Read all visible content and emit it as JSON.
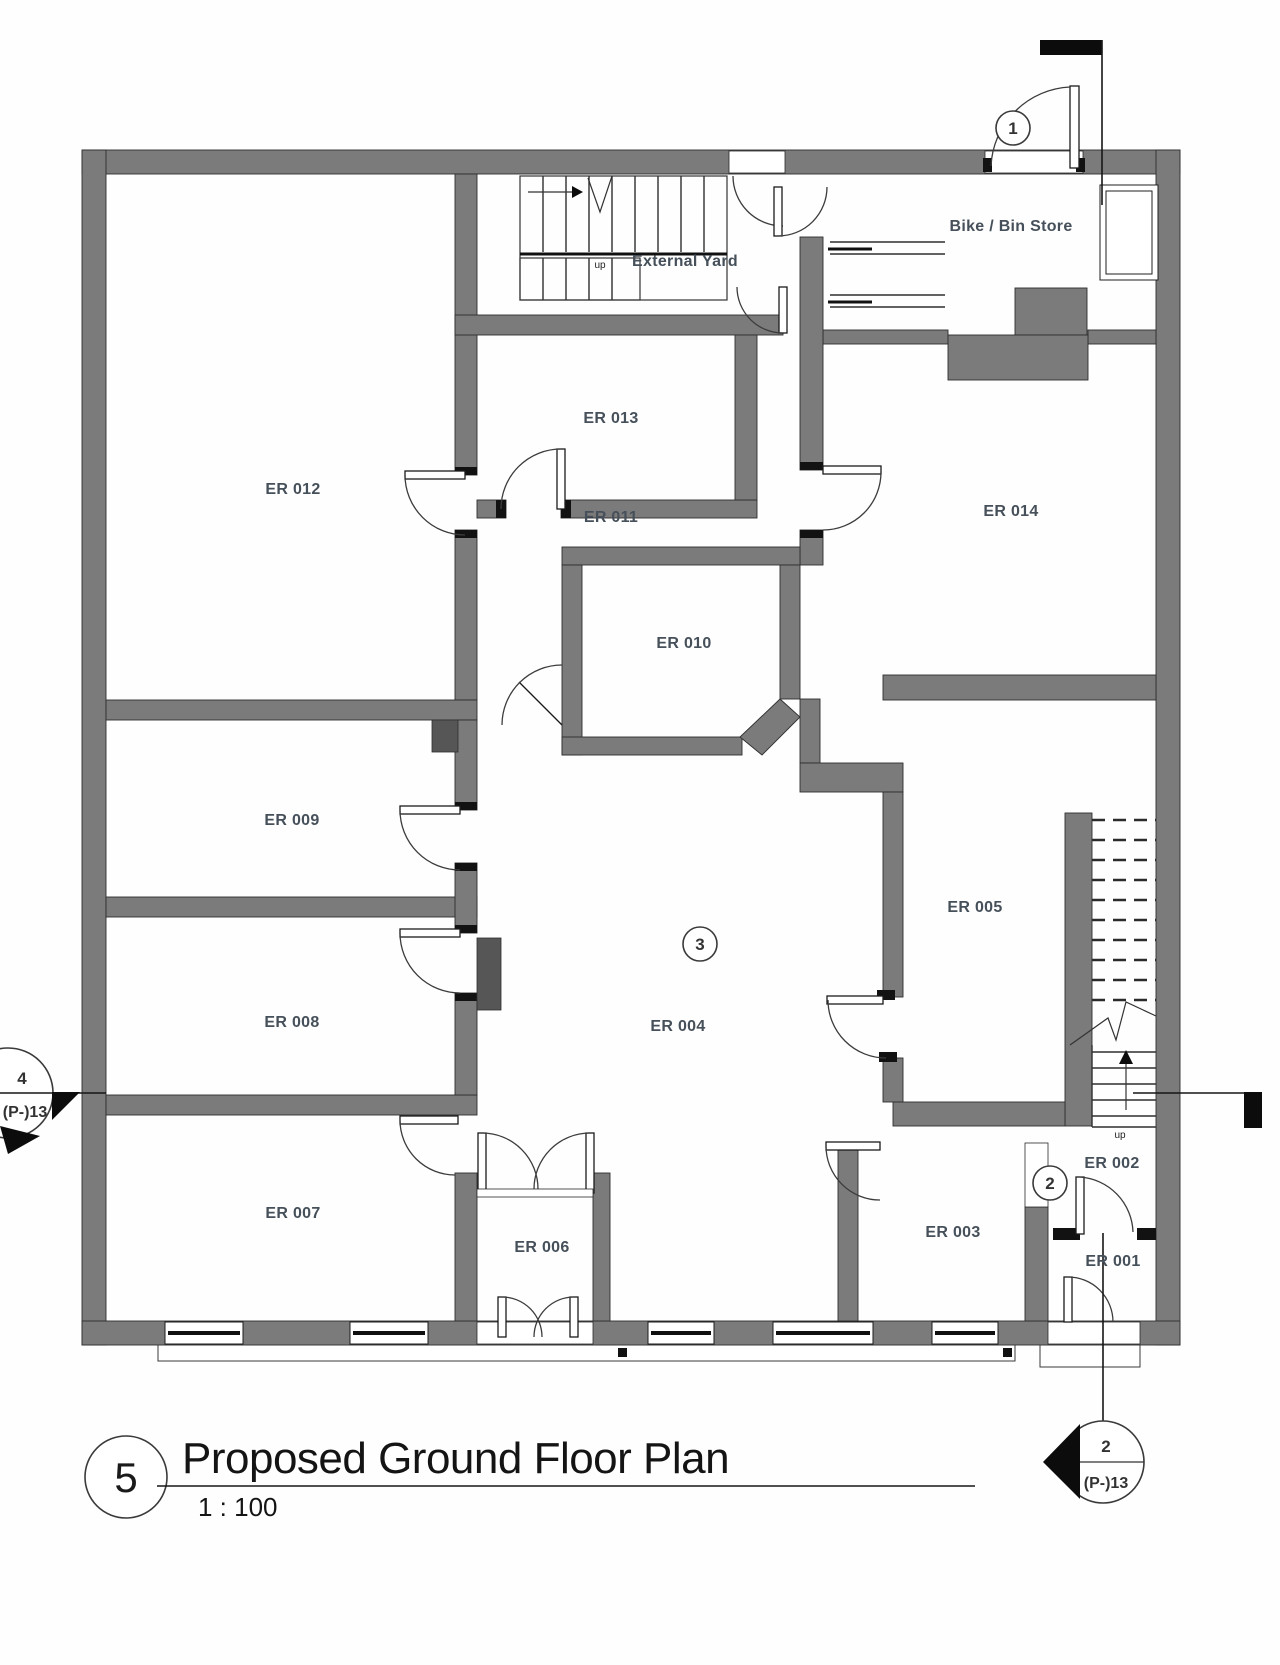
{
  "drawing": {
    "number": "5",
    "title": "Proposed Ground Floor Plan",
    "scale": "1 : 100"
  },
  "rooms": {
    "er001": "ER 001",
    "er002": "ER 002",
    "er003": "ER 003",
    "er004": "ER 004",
    "er005": "ER 005",
    "er006": "ER 006",
    "er007": "ER 007",
    "er008": "ER 008",
    "er009": "ER 009",
    "er010": "ER 010",
    "er011": "ER 011",
    "er012": "ER 012",
    "er013": "ER 013",
    "er014": "ER 014"
  },
  "areas": {
    "external_yard": "External Yard",
    "bike_bin_store": "Bike / Bin Store"
  },
  "stair": {
    "up_label": "up"
  },
  "markers": {
    "door_ref": "1",
    "lobby_ref": "2",
    "hall_ref": "3",
    "section_left": {
      "number": "4",
      "sheet": "(P-)13"
    },
    "section_bottom_right": {
      "number": "2",
      "sheet": "(P-)13"
    }
  },
  "colors": {
    "wall": "#7b7b7b",
    "outline": "#2e2e2e",
    "label": "#46505a",
    "line": "#222222"
  }
}
